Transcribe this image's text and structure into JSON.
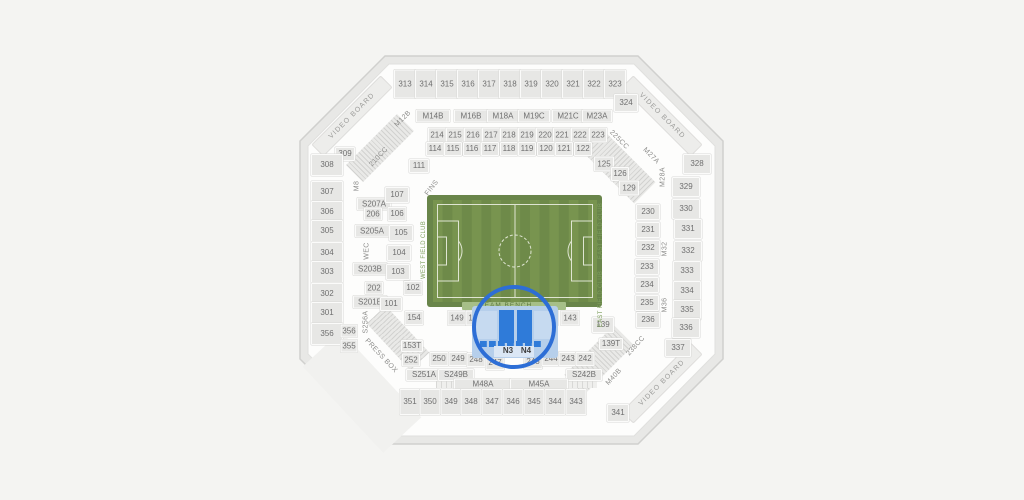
{
  "map_name": "stadium-seating-map",
  "selected_sections": [
    "N3",
    "N4"
  ],
  "colors": {
    "background": "#f4f4f2",
    "bowl": "#fdfdfc",
    "section_fill": "#e7e7e5",
    "section_text": "#6f6f6f",
    "field_green_dark": "#6e8a49",
    "field_green_light": "#78944f",
    "field_lines": "#dfe5d2",
    "bench_strip": "#a6bf88",
    "club_text": "#7fa05e",
    "highlight_circle": "#2d6ed6",
    "selected_fill": "#2f7bd9",
    "selected_area": "#b6cfeb"
  },
  "sections": [
    {
      "label": "313",
      "x": 405,
      "y": 84,
      "w": 20,
      "h": 27
    },
    {
      "label": "314",
      "x": 426,
      "y": 84,
      "w": 20,
      "h": 27
    },
    {
      "label": "315",
      "x": 447,
      "y": 84,
      "w": 20,
      "h": 27
    },
    {
      "label": "316",
      "x": 468,
      "y": 84,
      "w": 20,
      "h": 27
    },
    {
      "label": "317",
      "x": 489,
      "y": 84,
      "w": 20,
      "h": 27
    },
    {
      "label": "318",
      "x": 510,
      "y": 84,
      "w": 20,
      "h": 27
    },
    {
      "label": "319",
      "x": 531,
      "y": 84,
      "w": 20,
      "h": 27
    },
    {
      "label": "320",
      "x": 552,
      "y": 84,
      "w": 20,
      "h": 27
    },
    {
      "label": "321",
      "x": 573,
      "y": 84,
      "w": 20,
      "h": 27
    },
    {
      "label": "322",
      "x": 594,
      "y": 84,
      "w": 20,
      "h": 27
    },
    {
      "label": "323",
      "x": 615,
      "y": 84,
      "w": 20,
      "h": 27
    },
    {
      "label": "M14B",
      "x": 433,
      "y": 116,
      "w": 32,
      "h": 11
    },
    {
      "label": "M16B",
      "x": 471,
      "y": 116,
      "w": 32,
      "h": 11
    },
    {
      "label": "M18A",
      "x": 503,
      "y": 116,
      "w": 30,
      "h": 11
    },
    {
      "label": "M19C",
      "x": 534,
      "y": 116,
      "w": 30,
      "h": 11
    },
    {
      "label": "M21C",
      "x": 568,
      "y": 116,
      "w": 30,
      "h": 11
    },
    {
      "label": "M23A",
      "x": 597,
      "y": 116,
      "w": 28,
      "h": 11
    },
    {
      "label": "214",
      "x": 437,
      "y": 135,
      "w": 16,
      "h": 13
    },
    {
      "label": "215",
      "x": 455,
      "y": 135,
      "w": 16,
      "h": 13
    },
    {
      "label": "216",
      "x": 473,
      "y": 135,
      "w": 16,
      "h": 13
    },
    {
      "label": "217",
      "x": 491,
      "y": 135,
      "w": 16,
      "h": 13
    },
    {
      "label": "218",
      "x": 509,
      "y": 135,
      "w": 16,
      "h": 13
    },
    {
      "label": "219",
      "x": 527,
      "y": 135,
      "w": 16,
      "h": 13
    },
    {
      "label": "220",
      "x": 545,
      "y": 135,
      "w": 16,
      "h": 13
    },
    {
      "label": "221",
      "x": 562,
      "y": 135,
      "w": 16,
      "h": 13
    },
    {
      "label": "222",
      "x": 580,
      "y": 135,
      "w": 16,
      "h": 13
    },
    {
      "label": "223",
      "x": 598,
      "y": 135,
      "w": 16,
      "h": 13
    },
    {
      "label": "114",
      "x": 435,
      "y": 149,
      "w": 16,
      "h": 12
    },
    {
      "label": "115",
      "x": 453,
      "y": 149,
      "w": 16,
      "h": 12
    },
    {
      "label": "116",
      "x": 472,
      "y": 149,
      "w": 16,
      "h": 12
    },
    {
      "label": "117",
      "x": 490,
      "y": 149,
      "w": 16,
      "h": 12
    },
    {
      "label": "118",
      "x": 509,
      "y": 149,
      "w": 16,
      "h": 12
    },
    {
      "label": "119",
      "x": 527,
      "y": 149,
      "w": 16,
      "h": 12
    },
    {
      "label": "120",
      "x": 546,
      "y": 149,
      "w": 16,
      "h": 12
    },
    {
      "label": "121",
      "x": 564,
      "y": 149,
      "w": 16,
      "h": 12
    },
    {
      "label": "122",
      "x": 583,
      "y": 149,
      "w": 16,
      "h": 12
    },
    {
      "label": "111",
      "x": 419,
      "y": 166,
      "w": 18,
      "h": 12
    },
    {
      "label": "309",
      "x": 345,
      "y": 154,
      "w": 18,
      "h": 12
    },
    {
      "label": "324",
      "x": 626,
      "y": 103,
      "w": 22,
      "h": 16
    },
    {
      "label": "125",
      "x": 604,
      "y": 164,
      "w": 18,
      "h": 13
    },
    {
      "label": "126",
      "x": 620,
      "y": 174,
      "w": 16,
      "h": 12
    },
    {
      "label": "129",
      "x": 629,
      "y": 188,
      "w": 18,
      "h": 13
    },
    {
      "label": "308",
      "x": 327,
      "y": 165,
      "w": 30,
      "h": 20
    },
    {
      "label": "307",
      "x": 327,
      "y": 192,
      "w": 30,
      "h": 20
    },
    {
      "label": "306",
      "x": 327,
      "y": 212,
      "w": 30,
      "h": 20
    },
    {
      "label": "305",
      "x": 327,
      "y": 231,
      "w": 30,
      "h": 20
    },
    {
      "label": "304",
      "x": 327,
      "y": 253,
      "w": 30,
      "h": 20
    },
    {
      "label": "303",
      "x": 327,
      "y": 272,
      "w": 30,
      "h": 20
    },
    {
      "label": "302",
      "x": 327,
      "y": 294,
      "w": 30,
      "h": 20
    },
    {
      "label": "301",
      "x": 327,
      "y": 313,
      "w": 30,
      "h": 20
    },
    {
      "label": "356",
      "x": 327,
      "y": 334,
      "w": 30,
      "h": 20
    },
    {
      "label": "356",
      "x": 349,
      "y": 331,
      "w": 15,
      "h": 11
    },
    {
      "label": "355",
      "x": 349,
      "y": 346,
      "w": 15,
      "h": 11
    },
    {
      "label": "S207A",
      "x": 374,
      "y": 204,
      "w": 32,
      "h": 11
    },
    {
      "label": "S205A",
      "x": 372,
      "y": 231,
      "w": 32,
      "h": 11
    },
    {
      "label": "S203B",
      "x": 370,
      "y": 269,
      "w": 32,
      "h": 11
    },
    {
      "label": "S201B",
      "x": 370,
      "y": 302,
      "w": 32,
      "h": 11
    },
    {
      "label": "107",
      "x": 397,
      "y": 195,
      "w": 22,
      "h": 14
    },
    {
      "label": "206",
      "x": 373,
      "y": 214,
      "w": 16,
      "h": 11
    },
    {
      "label": "106",
      "x": 397,
      "y": 214,
      "w": 17,
      "h": 12
    },
    {
      "label": "105",
      "x": 401,
      "y": 233,
      "w": 22,
      "h": 14
    },
    {
      "label": "104",
      "x": 399,
      "y": 253,
      "w": 22,
      "h": 14
    },
    {
      "label": "103",
      "x": 398,
      "y": 272,
      "w": 22,
      "h": 14
    },
    {
      "label": "202",
      "x": 374,
      "y": 288,
      "w": 16,
      "h": 11
    },
    {
      "label": "102",
      "x": 413,
      "y": 288,
      "w": 17,
      "h": 12
    },
    {
      "label": "101",
      "x": 391,
      "y": 304,
      "w": 20,
      "h": 12
    },
    {
      "label": "154",
      "x": 414,
      "y": 318,
      "w": 17,
      "h": 12
    },
    {
      "label": "230",
      "x": 648,
      "y": 212,
      "w": 22,
      "h": 14
    },
    {
      "label": "231",
      "x": 648,
      "y": 230,
      "w": 22,
      "h": 14
    },
    {
      "label": "232",
      "x": 648,
      "y": 248,
      "w": 22,
      "h": 14
    },
    {
      "label": "233",
      "x": 647,
      "y": 267,
      "w": 22,
      "h": 14
    },
    {
      "label": "234",
      "x": 647,
      "y": 285,
      "w": 22,
      "h": 14
    },
    {
      "label": "235",
      "x": 647,
      "y": 303,
      "w": 22,
      "h": 14
    },
    {
      "label": "236",
      "x": 648,
      "y": 320,
      "w": 22,
      "h": 14
    },
    {
      "label": "328",
      "x": 697,
      "y": 164,
      "w": 26,
      "h": 18
    },
    {
      "label": "329",
      "x": 686,
      "y": 187,
      "w": 26,
      "h": 18
    },
    {
      "label": "330",
      "x": 686,
      "y": 209,
      "w": 26,
      "h": 18
    },
    {
      "label": "331",
      "x": 688,
      "y": 229,
      "w": 26,
      "h": 18
    },
    {
      "label": "332",
      "x": 688,
      "y": 251,
      "w": 26,
      "h": 18
    },
    {
      "label": "333",
      "x": 687,
      "y": 271,
      "w": 26,
      "h": 18
    },
    {
      "label": "334",
      "x": 687,
      "y": 291,
      "w": 26,
      "h": 18
    },
    {
      "label": "335",
      "x": 687,
      "y": 310,
      "w": 26,
      "h": 18
    },
    {
      "label": "336",
      "x": 686,
      "y": 328,
      "w": 26,
      "h": 18
    },
    {
      "label": "337",
      "x": 678,
      "y": 348,
      "w": 24,
      "h": 16
    },
    {
      "label": "149",
      "x": 457,
      "y": 318,
      "w": 17,
      "h": 13
    },
    {
      "label": "148",
      "x": 475,
      "y": 318,
      "w": 17,
      "h": 13
    },
    {
      "label": "144",
      "x": 549,
      "y": 318,
      "w": 17,
      "h": 13
    },
    {
      "label": "143",
      "x": 570,
      "y": 318,
      "w": 17,
      "h": 13
    },
    {
      "label": "139",
      "x": 603,
      "y": 325,
      "w": 20,
      "h": 14
    },
    {
      "label": "139T",
      "x": 611,
      "y": 344,
      "w": 22,
      "h": 10
    },
    {
      "label": "153T",
      "x": 412,
      "y": 346,
      "w": 20,
      "h": 10
    },
    {
      "label": "252",
      "x": 411,
      "y": 360,
      "w": 16,
      "h": 11
    },
    {
      "label": "250",
      "x": 439,
      "y": 359,
      "w": 17,
      "h": 12
    },
    {
      "label": "249",
      "x": 458,
      "y": 359,
      "w": 17,
      "h": 12
    },
    {
      "label": "248",
      "x": 476,
      "y": 360,
      "w": 17,
      "h": 12
    },
    {
      "label": "247",
      "x": 495,
      "y": 363,
      "w": 17,
      "h": 12
    },
    {
      "label": "245",
      "x": 533,
      "y": 362,
      "w": 17,
      "h": 12
    },
    {
      "label": "244",
      "x": 551,
      "y": 359,
      "w": 17,
      "h": 12
    },
    {
      "label": "243",
      "x": 568,
      "y": 359,
      "w": 17,
      "h": 12
    },
    {
      "label": "242",
      "x": 585,
      "y": 359,
      "w": 17,
      "h": 12
    },
    {
      "label": "S251A",
      "x": 424,
      "y": 375,
      "w": 34,
      "h": 10
    },
    {
      "label": "S249B",
      "x": 456,
      "y": 375,
      "w": 34,
      "h": 10
    },
    {
      "label": "S242B",
      "x": 584,
      "y": 375,
      "w": 34,
      "h": 10
    },
    {
      "label": "M48A",
      "x": 483,
      "y": 384,
      "w": 56,
      "h": 9
    },
    {
      "label": "M45A",
      "x": 539,
      "y": 384,
      "w": 56,
      "h": 9
    },
    {
      "label": "351",
      "x": 410,
      "y": 402,
      "w": 19,
      "h": 24
    },
    {
      "label": "350",
      "x": 430,
      "y": 402,
      "w": 19,
      "h": 24
    },
    {
      "label": "349",
      "x": 451,
      "y": 402,
      "w": 19,
      "h": 24
    },
    {
      "label": "348",
      "x": 471,
      "y": 402,
      "w": 19,
      "h": 24
    },
    {
      "label": "347",
      "x": 492,
      "y": 402,
      "w": 19,
      "h": 24
    },
    {
      "label": "346",
      "x": 513,
      "y": 402,
      "w": 19,
      "h": 24
    },
    {
      "label": "345",
      "x": 534,
      "y": 402,
      "w": 19,
      "h": 24
    },
    {
      "label": "344",
      "x": 555,
      "y": 402,
      "w": 19,
      "h": 24
    },
    {
      "label": "343",
      "x": 576,
      "y": 402,
      "w": 19,
      "h": 24
    },
    {
      "label": "341",
      "x": 618,
      "y": 413,
      "w": 20,
      "h": 16
    }
  ],
  "labels": [
    {
      "label": "VIDEO BOARD",
      "x": 352,
      "y": 116,
      "rot": -45,
      "cls": "board"
    },
    {
      "label": "VIDEO BOARD",
      "x": 662,
      "y": 116,
      "rot": 45,
      "cls": "board"
    },
    {
      "label": "VIDEO BOARD",
      "x": 662,
      "y": 383,
      "rot": -45,
      "cls": "board"
    },
    {
      "label": "M12B",
      "x": 403,
      "y": 119,
      "rot": -45,
      "cls": "decor"
    },
    {
      "label": "210CC",
      "x": 379,
      "y": 157,
      "rot": -47,
      "cls": "decor"
    },
    {
      "label": "225CC",
      "x": 619,
      "y": 140,
      "rot": 45,
      "cls": "decor"
    },
    {
      "label": "M27A",
      "x": 651,
      "y": 156,
      "rot": 45,
      "cls": "decor"
    },
    {
      "label": "238CC",
      "x": 636,
      "y": 346,
      "rot": -48,
      "cls": "decor"
    },
    {
      "label": "M40B",
      "x": 614,
      "y": 377,
      "rot": -48,
      "cls": "decor"
    },
    {
      "label": "PRESS BOX",
      "x": 381,
      "y": 356,
      "rot": 47,
      "cls": "decor"
    },
    {
      "label": "FINS",
      "x": 432,
      "y": 188,
      "rot": -52,
      "cls": "decor"
    },
    {
      "label": "M8",
      "x": 357,
      "y": 186,
      "rot": -90,
      "cls": "decor"
    },
    {
      "label": "WEC",
      "x": 367,
      "y": 251,
      "rot": -90,
      "cls": "decor"
    },
    {
      "label": "S256A",
      "x": 366,
      "y": 322,
      "rot": -90,
      "cls": "decor"
    },
    {
      "label": "M28A",
      "x": 663,
      "y": 177,
      "rot": -90,
      "cls": "decor"
    },
    {
      "label": "M32",
      "x": 665,
      "y": 249,
      "rot": -90,
      "cls": "decor"
    },
    {
      "label": "M36",
      "x": 665,
      "y": 305,
      "rot": -90,
      "cls": "decor"
    },
    {
      "label": "WEST FIELD CLUB",
      "x": 424,
      "y": 250,
      "rot": -90,
      "cls": "green"
    },
    {
      "label": "EAST FIELD CLUB",
      "x": 601,
      "y": 231,
      "rot": -90,
      "cls": "green"
    },
    {
      "label": "EAST FIELD CLUB",
      "x": 601,
      "y": 299,
      "rot": -90,
      "cls": "green"
    },
    {
      "label": "TEAM BENCH",
      "x": 506,
      "y": 306,
      "rot": 0,
      "cls": "bench"
    }
  ],
  "highlight": {
    "color": "#2d6ed6",
    "circle": {
      "cx": 514,
      "cy": 327,
      "r": 40
    },
    "labels": [
      {
        "label": "N3",
        "x": 508,
        "y": 351
      },
      {
        "label": "N4",
        "x": 526,
        "y": 351
      }
    ]
  }
}
